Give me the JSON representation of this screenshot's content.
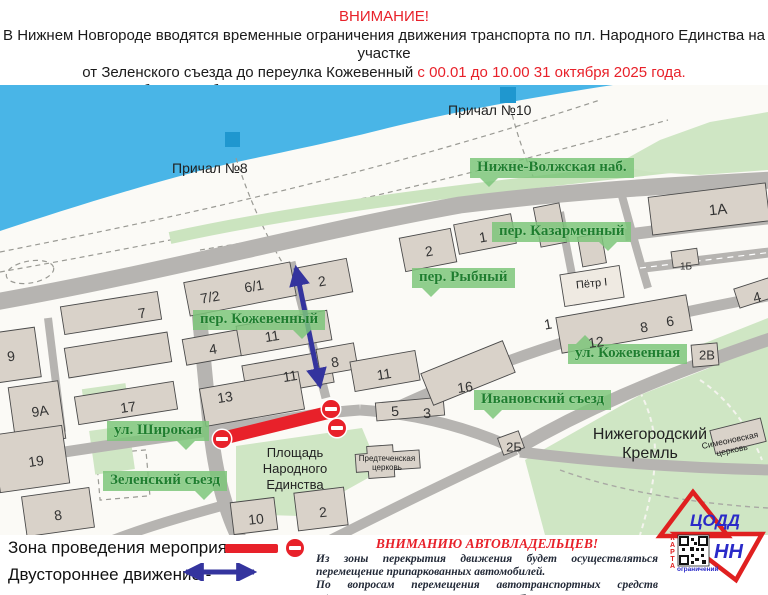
{
  "header": {
    "line1": "ВНИМАНИЕ!",
    "line2": "В Нижнем Новгороде вводятся временные ограничения движения транспорта по пл. Народного Единства на участке",
    "line3_black": "от Зеленского съезда до переулка Кожевенный",
    "line3_red": " с 00.01 до 10.00 31 октября 2025 года.",
    "line4": "Просим автомобилистов быть предельно внимательными и следовать указаниям дорожных знаков."
  },
  "map": {
    "pier8": "Причал №8",
    "pier10": "Причал №10",
    "places": {
      "square": "Площадь\nНародного\nЕдинства",
      "kremlin": "Нижегородский\nКремль",
      "peter": "Пётр I",
      "church1": "Предтеченская\nцерковь",
      "church2": "Симеоновская\nцерковь"
    },
    "street_labels": [
      {
        "label": "Нижне-Волжская наб.",
        "x": 470,
        "y": 73,
        "pointer": "down-left"
      },
      {
        "label": "пер. Казарменный",
        "x": 492,
        "y": 137,
        "pointer": "down-right"
      },
      {
        "label": "пер. Рыбный",
        "x": 412,
        "y": 183,
        "pointer": "down-left"
      },
      {
        "label": "пер. Кожевенный",
        "x": 193,
        "y": 225,
        "pointer": "down-right"
      },
      {
        "label": "ул. Кожевенная",
        "x": 568,
        "y": 259,
        "pointer": "up-left"
      },
      {
        "label": "Ивановский съезд",
        "x": 474,
        "y": 305,
        "pointer": "down-left"
      },
      {
        "label": "ул. Широкая",
        "x": 107,
        "y": 336,
        "pointer": "down-right"
      },
      {
        "label": "Зеленский съезд",
        "x": 103,
        "y": 386,
        "pointer": "down-right"
      }
    ],
    "buildings": [
      {
        "label": "1А",
        "x": 718,
        "y": 125,
        "fs": 15,
        "r": -6
      },
      {
        "label": "1Б",
        "x": 686,
        "y": 182,
        "fs": 10
      },
      {
        "label": "2",
        "x": 429,
        "y": 166,
        "r": -10
      },
      {
        "label": "1",
        "x": 483,
        "y": 152,
        "r": -10
      },
      {
        "label": "2",
        "x": 322,
        "y": 196,
        "r": -10
      },
      {
        "label": "7/2",
        "x": 210,
        "y": 212,
        "r": -10
      },
      {
        "label": "6/1",
        "x": 254,
        "y": 201,
        "r": -10
      },
      {
        "label": "7",
        "x": 142,
        "y": 228,
        "r": -9
      },
      {
        "label": "9",
        "x": 11,
        "y": 271,
        "r": -8
      },
      {
        "label": "9А",
        "x": 40,
        "y": 326,
        "r": -8
      },
      {
        "label": "17",
        "x": 128,
        "y": 322,
        "r": -8
      },
      {
        "label": "19",
        "x": 36,
        "y": 376,
        "r": -8
      },
      {
        "label": "8",
        "x": 58,
        "y": 430,
        "r": -8
      },
      {
        "label": "4",
        "x": 213,
        "y": 264,
        "r": -9
      },
      {
        "label": "11",
        "x": 272,
        "y": 251,
        "r": -9
      },
      {
        "label": "11",
        "x": 290,
        "y": 291,
        "r": -9
      },
      {
        "label": "8",
        "x": 335,
        "y": 277,
        "r": -9
      },
      {
        "label": "11",
        "x": 384,
        "y": 289,
        "r": -9
      },
      {
        "label": "13",
        "x": 225,
        "y": 312,
        "r": -9
      },
      {
        "label": "5",
        "x": 395,
        "y": 326,
        "r": -4
      },
      {
        "label": "3",
        "x": 427,
        "y": 328,
        "r": -4
      },
      {
        "label": "16",
        "x": 465,
        "y": 302,
        "r": -8
      },
      {
        "label": "1",
        "x": 548,
        "y": 239,
        "r": -10
      },
      {
        "label": "12",
        "x": 596,
        "y": 257,
        "r": -8
      },
      {
        "label": "8",
        "x": 644,
        "y": 242,
        "r": -8
      },
      {
        "label": "6",
        "x": 670,
        "y": 236,
        "r": -8
      },
      {
        "label": "2В",
        "x": 707,
        "y": 270,
        "fs": 13
      },
      {
        "label": "4",
        "x": 757,
        "y": 212,
        "r": -15
      },
      {
        "label": "2Б",
        "x": 514,
        "y": 362,
        "fs": 13
      },
      {
        "label": "10",
        "x": 256,
        "y": 434,
        "r": -6
      },
      {
        "label": "2",
        "x": 323,
        "y": 427,
        "r": -6
      }
    ]
  },
  "legend": {
    "zone_label": "Зона проведения мероприятия -",
    "twoway_label": "Двустороннее движение -"
  },
  "notice": {
    "title": "ВНИМАНИЮ АВТОВЛАДЕЛЬЦЕВ!",
    "p1": "Из зоны перекрытия движения будет осуществляться перемещение припаркованных автомобилей.",
    "p2": "По вопросам перемещения автотранспортных средств обращаться по телефону",
    "phone": "417-17-07"
  },
  "logo": {
    "top": "ЦОДД",
    "bottom": "НН",
    "qr_side": "КАРТА",
    "qr_caption": "ограничений"
  },
  "colors": {
    "accent_red": "#e8212a",
    "label_green_bg": "#7cc67a",
    "label_green_text": "#1e7e2e",
    "water_blue": "#49b5e7",
    "arrow_blue": "#34349e",
    "pier_blue": "#1f97cf"
  }
}
